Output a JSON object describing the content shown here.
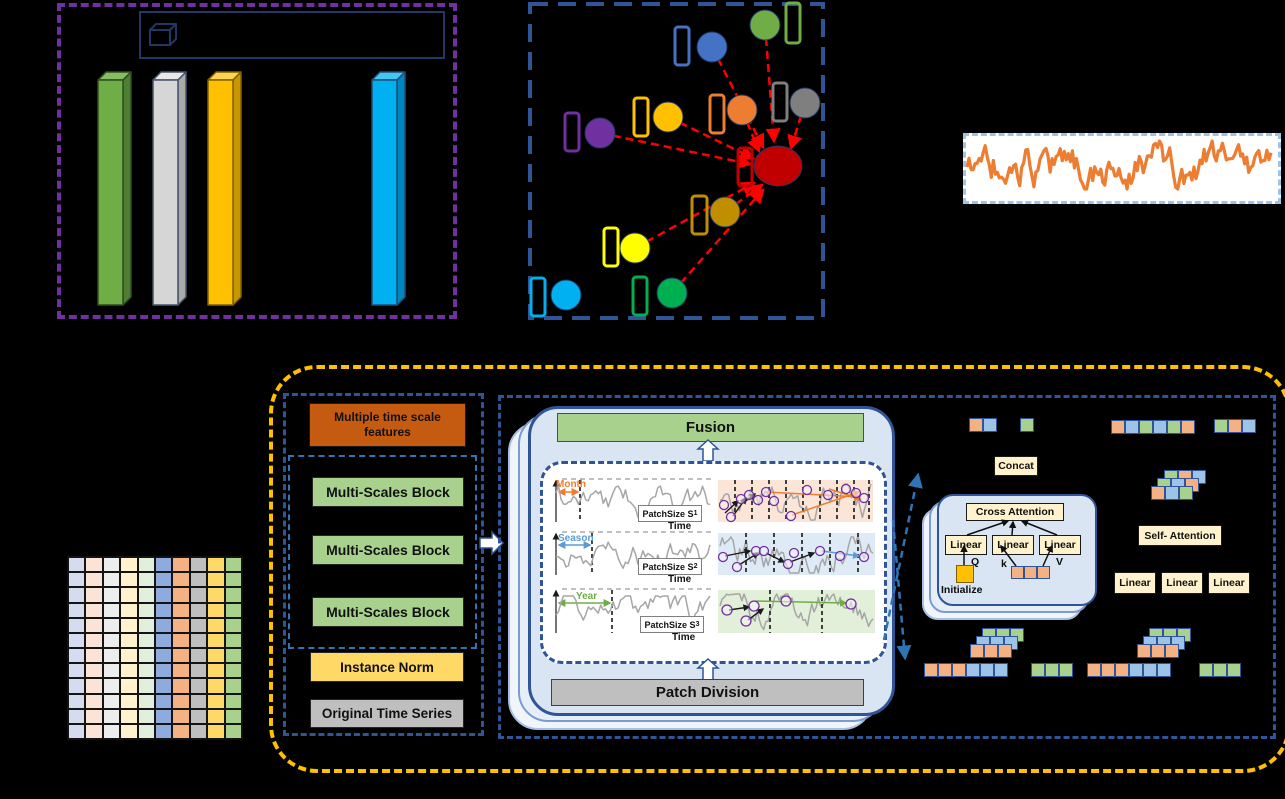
{
  "figure": {
    "description_labels": {
      "fusion": "Fusion",
      "patch_division": "Patch Division"
    }
  },
  "colors": {
    "background": "#000000",
    "purple_dash": "#7030A0",
    "blue_dash": "#2F5597",
    "yellow_dash": "#FFC000",
    "red_arrow": "#FF0000",
    "light_blue_dash": "#9DC3E6",
    "series_line": "#ED7D31",
    "tokens": {
      "orange": "#F4B183",
      "blue": "#9DC3E6",
      "green": "#A9D18E"
    }
  },
  "scale_chart": {
    "type": "bar",
    "bars": [
      {
        "id": "green",
        "front": "#6FAD46",
        "side": "#4F7D31",
        "top": "#85BD60",
        "stroke": "#2F4F1F"
      },
      {
        "id": "silver",
        "front": "#D6D6D6",
        "side": "#ACA9A9",
        "top": "#E8E8E8",
        "stroke": "#44546A"
      },
      {
        "id": "gold",
        "front": "#FFC000",
        "side": "#C89600",
        "top": "#FFD34D",
        "stroke": "#7F6000"
      },
      {
        "id": "cyan",
        "front": "#00B0F0",
        "side": "#0086BE",
        "top": "#45C5F2",
        "stroke": "#1F4E79"
      }
    ],
    "note_heights_px": [
      225,
      225,
      225,
      225
    ]
  },
  "graph": {
    "nodes": [
      {
        "id": "blue",
        "color": "#4472C4"
      },
      {
        "id": "green",
        "color": "#70AD47"
      },
      {
        "id": "gray",
        "color": "#7F7F7F"
      },
      {
        "id": "orange",
        "color": "#ED7D31"
      },
      {
        "id": "gold",
        "color": "#FFC000"
      },
      {
        "id": "purple",
        "color": "#7030A0"
      },
      {
        "id": "red",
        "color": "#C00000"
      },
      {
        "id": "dark-gold",
        "color": "#BF8F00"
      },
      {
        "id": "yellow",
        "color": "#FFFF00"
      },
      {
        "id": "cyan",
        "color": "#00B0F0"
      },
      {
        "id": "dark-green",
        "color": "#00B050"
      }
    ]
  },
  "architecture": {
    "left_column": {
      "header": "Multiple time scale features",
      "blocks": [
        {
          "label": "Multi-Scales Block"
        },
        {
          "label": "Multi-Scales Block"
        },
        {
          "label": "Multi-Scales Block"
        }
      ],
      "instance_norm": "Instance Norm",
      "original_series": "Original Time Series"
    },
    "center": {
      "fusion": "Fusion",
      "patch_division": "Patch Division",
      "rows": [
        {
          "label": "Month",
          "color": "#ED7D31",
          "patch": "PatchSize S",
          "sub": "1",
          "time": "Time"
        },
        {
          "label": "Season",
          "color": "#5B9BD5",
          "patch": "PatchSize S",
          "sub": "2",
          "time": "Time"
        },
        {
          "label": "Year",
          "color": "#70AD47",
          "patch": "PatchSize S",
          "sub": "3",
          "time": "Time"
        }
      ]
    },
    "right": {
      "concat": "Concat",
      "cross_attention": "Cross Attention",
      "linear": "Linear",
      "q": "Q",
      "k": "k",
      "v": "V",
      "initialize": "Initialize",
      "self_attention": "Self- Attention"
    }
  },
  "token_rows": {
    "top_pair": [
      "orange",
      "blue"
    ],
    "top_single": [
      "green"
    ],
    "top_long": [
      "orange",
      "blue",
      "green",
      "blue",
      "green",
      "orange"
    ],
    "top_trio": [
      "green",
      "orange",
      "blue"
    ],
    "mix_back": [
      "green",
      "orange",
      "blue"
    ],
    "mix_mid": [
      "green",
      "blue",
      "orange"
    ],
    "mix_front": [
      "orange",
      "blue",
      "green"
    ],
    "ca_row": [
      "orange",
      "orange",
      "orange"
    ],
    "stack_green": [
      "green",
      "green",
      "green"
    ],
    "stack_blue": [
      "blue",
      "blue",
      "blue"
    ],
    "stack_orange": [
      "orange",
      "orange",
      "orange"
    ],
    "bottom_six": [
      "orange",
      "orange",
      "orange",
      "blue",
      "blue",
      "blue"
    ],
    "bottom_green": [
      "green",
      "green",
      "green"
    ]
  },
  "matrix": {
    "rows": 12,
    "columns": [
      "#D6DCF0",
      "#FBE3D6",
      "#EDEDED",
      "#FFF2CC",
      "#E2EFDA",
      "#8FAADC",
      "#F4B183",
      "#BFBFBF",
      "#FFD966",
      "#A9D18E"
    ]
  }
}
